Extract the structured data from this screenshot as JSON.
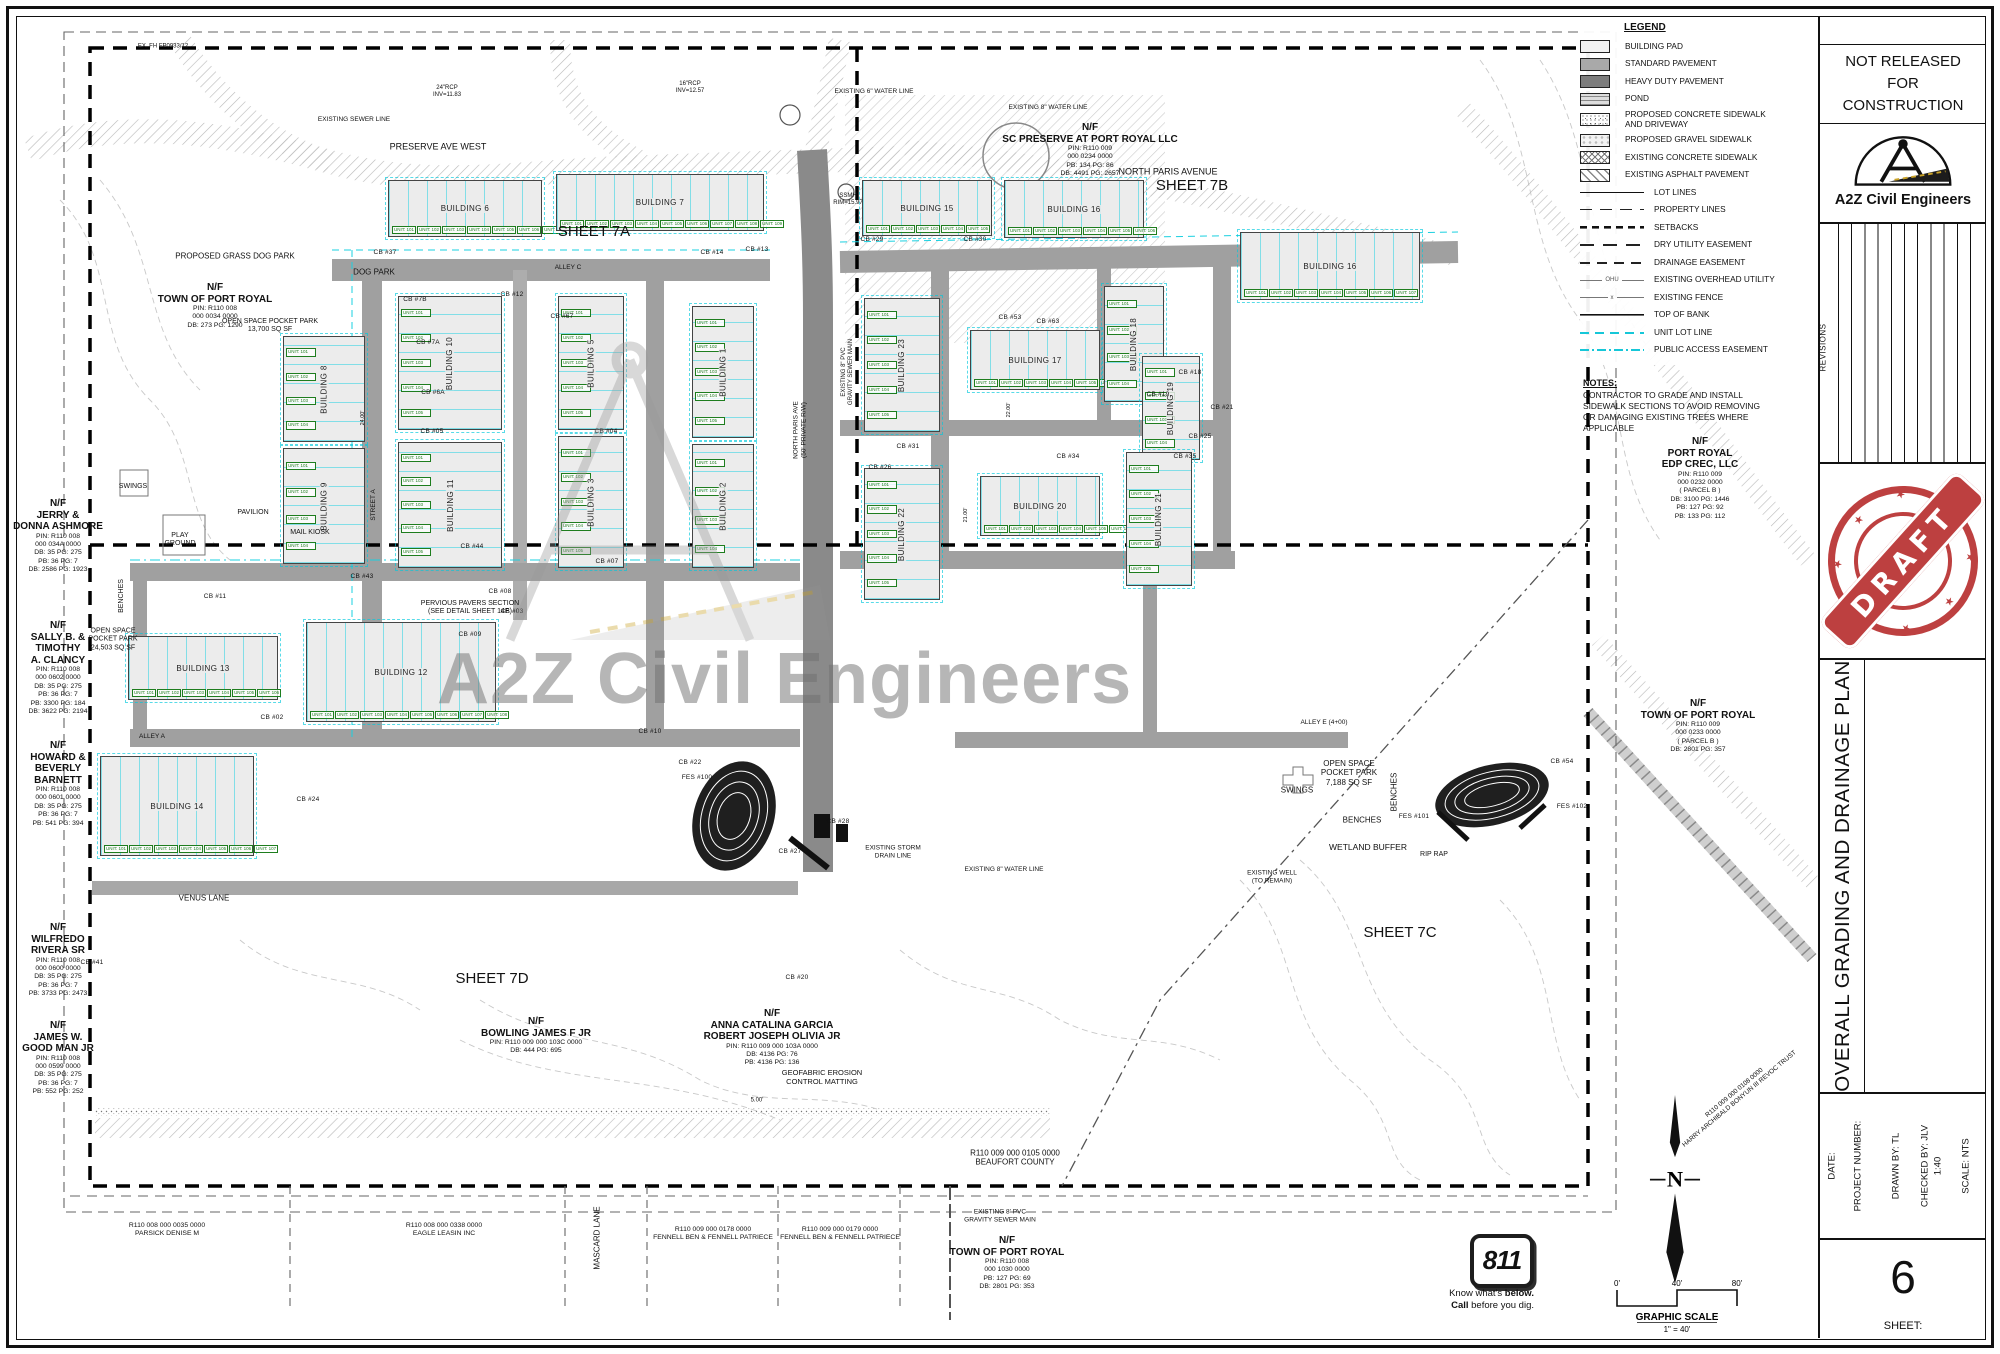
{
  "title_block": {
    "nr1": "NOT RELEASED",
    "nr2": "FOR",
    "nr3": "CONSTRUCTION",
    "firm": "A2Z Civil Engineers",
    "revisions": "REVISIONS",
    "stamp": "DRAFT",
    "sheet_title": "OVERALL GRADING AND DRAINAGE PLAN",
    "date": "DATE:",
    "project": "PROJECT NUMBER:",
    "drawn": "DRAWN BY:  TL",
    "checked": "CHECKED BY:  JLV",
    "ratio": "1:40",
    "scale": "SCALE: NTS",
    "sheet_label": "SHEET:",
    "sheet_number": "6",
    "stamp_color": "#b93232"
  },
  "legend": {
    "title": "LEGEND",
    "fills": [
      {
        "k": "pad",
        "label": "BUILDING PAD"
      },
      {
        "k": "std",
        "label": "STANDARD PAVEMENT"
      },
      {
        "k": "heavy",
        "label": "HEAVY DUTY PAVEMENT"
      },
      {
        "k": "pond",
        "label": "POND"
      },
      {
        "k": "conc",
        "label": "PROPOSED CONCRETE SIDEWALK\nAND DRIVEWAY"
      },
      {
        "k": "gravel",
        "label": "PROPOSED GRAVEL SIDEWALK"
      },
      {
        "k": "xconc",
        "label": "EXISTING CONCRETE SIDEWALK"
      },
      {
        "k": "asph",
        "label": "EXISTING ASPHALT PAVEMENT"
      }
    ],
    "lines": [
      {
        "k": "lot",
        "label": "LOT LINES"
      },
      {
        "k": "prop",
        "label": "PROPERTY LINES"
      },
      {
        "k": "set",
        "label": "SETBACKS"
      },
      {
        "k": "dry",
        "label": "DRY UTILITY EASEMENT"
      },
      {
        "k": "drain",
        "label": "DRAINAGE  EASEMENT"
      },
      {
        "k": "ohu",
        "label": "EXISTING OVERHEAD UTILITY",
        "mid": "OHU"
      },
      {
        "k": "fence",
        "label": "EXISTING FENCE",
        "mid": "x"
      },
      {
        "k": "bank",
        "label": "TOP OF BANK"
      },
      {
        "k": "unitl",
        "label": "UNIT LOT LINE"
      },
      {
        "k": "pub",
        "label": "PUBLIC ACCESS EASEMENT"
      }
    ],
    "unit_line_color": "#16c7d8"
  },
  "notes": {
    "title": "NOTES:",
    "lines": [
      "CONTRACTOR TO GRADE AND INSTALL",
      "SIDEWALK SECTIONS TO AVOID REMOVING",
      "OR DAMAGING EXISTING TREES WHERE",
      "APPLICABLE"
    ]
  },
  "watermark": {
    "text": "A2Z Civil Engineers"
  },
  "north_label": "N",
  "scalebar": {
    "t0": "0'",
    "t40": "40'",
    "t80": "80'",
    "title": "GRAPHIC SCALE",
    "ratio": "1\" = 40'"
  },
  "call811": {
    "number": "811",
    "know": "Know what's ",
    "below": "below.",
    "call": "Call ",
    "dig": "before you dig."
  },
  "plan": {
    "unit_prefix": "UNIT: ",
    "owners": [
      {
        "x": 215,
        "y": 282,
        "b": [
          "N/F",
          "TOWN OF PORT ROYAL"
        ],
        "s": [
          "PIN: R110 008",
          "000 0034 0000",
          "DB: 273      PG: 1290"
        ]
      },
      {
        "x": 58,
        "y": 498,
        "b": [
          "N/F",
          "JERRY &",
          "DONNA ASHMORE"
        ],
        "s": [
          "PIN: R110 008",
          "000 034A 0000",
          "DB: 35      PG: 275",
          "PB: 36      PG: 7",
          "DB: 2586    PG: 1923"
        ]
      },
      {
        "x": 58,
        "y": 620,
        "b": [
          "N/F",
          "SALLY B. &",
          "TIMOTHY",
          "A. CLANCY"
        ],
        "s": [
          "PIN: R110 008",
          "000 0602 0000",
          "DB: 35      PG: 275",
          "PB: 36      PG: 7",
          "PB: 3300    PG: 184",
          "DB: 3622    PG: 2194"
        ]
      },
      {
        "x": 58,
        "y": 740,
        "b": [
          "N/F",
          "HOWARD &",
          "BEVERLY",
          "BARNETT"
        ],
        "s": [
          "PIN: R110 008",
          "000 0601 0000",
          "DB: 35      PG: 275",
          "PB: 36      PG: 7",
          "PB: 541      PG: 394"
        ]
      },
      {
        "x": 58,
        "y": 922,
        "b": [
          "N/F",
          "WILFREDO",
          "RIVERA SR"
        ],
        "s": [
          "PIN: R110 008",
          "000 0600 0000",
          "DB: 35      PG: 275",
          "PB: 36      PG: 7",
          "PB: 3733    PG: 2473"
        ]
      },
      {
        "x": 58,
        "y": 1020,
        "b": [
          "N/F",
          "JAMES W.",
          "GOOD MAN JR"
        ],
        "s": [
          "PIN: R110 008",
          "000 0599 0000",
          "DB: 35      PG: 275",
          "PB: 36      PG: 7",
          "PB: 552      PG: 252"
        ]
      },
      {
        "x": 1090,
        "y": 122,
        "b": [
          "N/F",
          "SC PRESERVE AT PORT ROYAL LLC"
        ],
        "s": [
          "PIN: R110 009",
          "000 0234 0000",
          "PB: 134      PG: 86",
          "DB: 4491    PG: 2657"
        ]
      },
      {
        "x": 1700,
        "y": 436,
        "b": [
          "N/F",
          "PORT ROYAL",
          "EDP CREC, LLC"
        ],
        "s": [
          "PIN: R110 009",
          "000 0232 0000",
          "( PARCEL B )",
          "DB: 3100    PG: 1446",
          "PB: 127      PG: 92",
          "PB: 133      PG: 112"
        ]
      },
      {
        "x": 1698,
        "y": 698,
        "b": [
          "N/F",
          "TOWN OF PORT ROYAL"
        ],
        "s": [
          "PIN: R110 009",
          "000 0233 0000",
          "( PARCEL B )",
          "DB: 2801    PG: 357"
        ]
      },
      {
        "x": 536,
        "y": 1016,
        "b": [
          "N/F",
          "BOWLING JAMES F JR"
        ],
        "s": [
          "PIN: R110 009 000 103C 0000",
          "DB: 444      PG: 695"
        ]
      },
      {
        "x": 772,
        "y": 1008,
        "b": [
          "N/F",
          "ANNA CATALINA GARCIA",
          "ROBERT JOSEPH OLIVIA JR"
        ],
        "s": [
          "PIN: R110 009 000 103A 0000",
          "DB: 4136      PG: 76",
          "PB: 4136      PG: 136"
        ]
      },
      {
        "x": 1007,
        "y": 1235,
        "b": [
          "N/F",
          "TOWN OF PORT ROYAL"
        ],
        "s": [
          "PIN: R110 008",
          "000 1030 0000",
          "PB: 127      PG: 69",
          "DB: 2801    PG: 353"
        ]
      },
      {
        "x": 167,
        "y": 1222,
        "b": [],
        "s": [
          "R110 008 000 0035 0000",
          "PARSICK DENISE M"
        ]
      },
      {
        "x": 444,
        "y": 1222,
        "b": [],
        "s": [
          "R110 008 000 0338 0000",
          "EAGLE LEASIN INC"
        ]
      },
      {
        "x": 713,
        "y": 1226,
        "b": [],
        "s": [
          "R110 009 000 0178 0000",
          "FENNELL BEN & FENNELL PATRIECE"
        ]
      },
      {
        "x": 840,
        "y": 1226,
        "b": [],
        "s": [
          "R110 009 000 0179 0000",
          "FENNELL BEN & FENNELL PATRIECE"
        ]
      }
    ],
    "labels": [
      {
        "t": "PRESERVE AVE WEST",
        "x": 438,
        "y": 147,
        "s": 9
      },
      {
        "t": "NORTH PARIS AVENUE",
        "x": 1168,
        "y": 172,
        "s": 9
      },
      {
        "t": "SHEET 7A",
        "x": 594,
        "y": 232,
        "s": 15
      },
      {
        "t": "SHEET 7B",
        "x": 1192,
        "y": 186,
        "s": 15
      },
      {
        "t": "SHEET 7C",
        "x": 1400,
        "y": 933,
        "s": 15
      },
      {
        "t": "SHEET 7D",
        "x": 492,
        "y": 979,
        "s": 15
      },
      {
        "t": "VENUS LANE",
        "x": 204,
        "y": 898,
        "s": 8
      },
      {
        "t": "MASCARD LANE",
        "x": 597,
        "y": 1238,
        "r": -90,
        "s": 8
      },
      {
        "t": "DOG PARK",
        "x": 374,
        "y": 272,
        "s": 8
      },
      {
        "t": "PROPOSED GRASS DOG PARK",
        "x": 235,
        "y": 256,
        "s": 8
      },
      {
        "t": "OPEN SPACE POCKET PARK\n13,700 SQ SF",
        "x": 270,
        "y": 326,
        "s": 7
      },
      {
        "t": "OPEN SPACE\nPOCKET PARK\n24,503 SQ SF",
        "x": 113,
        "y": 640,
        "s": 7
      },
      {
        "t": "SWINGS",
        "x": 133,
        "y": 487,
        "s": 7
      },
      {
        "t": "PLAY\nGROUND",
        "x": 180,
        "y": 540,
        "s": 7
      },
      {
        "t": "PAVILION",
        "x": 253,
        "y": 513,
        "s": 7
      },
      {
        "t": "MAIL KIOSK",
        "x": 310,
        "y": 533,
        "s": 7
      },
      {
        "t": "BENCHES",
        "x": 122,
        "y": 596,
        "r": -90,
        "s": 7
      },
      {
        "t": "BENCHES",
        "x": 1394,
        "y": 792,
        "r": -90,
        "s": 8
      },
      {
        "t": "BENCHES",
        "x": 1362,
        "y": 820,
        "s": 8
      },
      {
        "t": "OPEN SPACE\nPOCKET PARK\n7,188 SQ SF",
        "x": 1349,
        "y": 773,
        "s": 8
      },
      {
        "t": "SWINGS",
        "x": 1297,
        "y": 790,
        "s": 8
      },
      {
        "t": "WETLAND BUFFER",
        "x": 1368,
        "y": 847,
        "s": 8.5
      },
      {
        "t": "RIP RAP",
        "x": 1434,
        "y": 855,
        "s": 7
      },
      {
        "t": "EXISTING WELL\n(TO REMAIN)",
        "x": 1272,
        "y": 877,
        "s": 6.5
      },
      {
        "t": "ALLEY E (4+00)",
        "x": 1324,
        "y": 723,
        "s": 6.5
      },
      {
        "t": "ALLEY C",
        "x": 568,
        "y": 268,
        "s": 6.5
      },
      {
        "t": "ALLEY A",
        "x": 152,
        "y": 737,
        "s": 6.5
      },
      {
        "t": "STREET A",
        "x": 374,
        "y": 505,
        "r": -90,
        "s": 6.5
      },
      {
        "t": "NORTH PARIS AVE\n(50' PRIVATE R/W)",
        "x": 800,
        "y": 430,
        "r": -90,
        "s": 6.5
      },
      {
        "t": "EXISTING 8\" PVC\nGRAVITY SEWER MAIN",
        "x": 848,
        "y": 372,
        "r": -90,
        "s": 6
      },
      {
        "t": "PERVIOUS PAVERS SECTION\n(SEE DETAIL SHEET 14E)",
        "x": 470,
        "y": 608,
        "s": 7
      },
      {
        "t": "GEOFABRIC EROSION\nCONTROL MATTING",
        "x": 822,
        "y": 1078,
        "s": 7.5
      },
      {
        "t": "EXISTING 8\" WATER LINE",
        "x": 1048,
        "y": 108,
        "s": 6.5
      },
      {
        "t": "EXISTING SEWER LINE",
        "x": 354,
        "y": 120,
        "s": 6.5
      },
      {
        "t": "EX. FH FP0933/12",
        "x": 163,
        "y": 47,
        "s": 6
      },
      {
        "t": "24\"RCP\nINV=11.83",
        "x": 447,
        "y": 92,
        "s": 6
      },
      {
        "t": "16\"RCP\nINV=12.57",
        "x": 690,
        "y": 88,
        "s": 6
      },
      {
        "t": "EXISTING 6\" WATER LINE",
        "x": 874,
        "y": 92,
        "s": 6.5
      },
      {
        "t": "EXISTING 8\" WATER LINE",
        "x": 1004,
        "y": 870,
        "s": 6.5
      },
      {
        "t": "EXISTING STORM\nDRAIN LINE",
        "x": 893,
        "y": 852,
        "s": 6.5
      },
      {
        "t": "EXISTING 8' PVC\nGRAVITY SEWER MAIN",
        "x": 1000,
        "y": 1216,
        "s": 6.5
      },
      {
        "t": "SSMH\nRIM=15.97",
        "x": 848,
        "y": 200,
        "s": 6
      },
      {
        "t": "R110 009 000 0105 0000\nBEAUFORT COUNTY",
        "x": 1015,
        "y": 1158,
        "s": 8
      },
      {
        "t": "R110 009 000 0108 0000\nHARRY ARCHIBALD BONYUN III REVOC TRUST",
        "x": 1737,
        "y": 1096,
        "r": -40,
        "s": 6.5
      },
      {
        "t": "5.00'",
        "x": 757,
        "y": 1101,
        "s": 6
      },
      {
        "t": "24.00'",
        "x": 363,
        "y": 418,
        "r": -90,
        "s": 5.5
      },
      {
        "t": "22.00'",
        "x": 1009,
        "y": 410,
        "r": -90,
        "s": 5.5
      },
      {
        "t": "21.00'",
        "x": 966,
        "y": 515,
        "r": -90,
        "s": 5.5
      },
      {
        "t": "CB #37",
        "x": 385,
        "y": 253,
        "c": "cb"
      },
      {
        "t": "CB #13",
        "x": 757,
        "y": 250,
        "c": "cb"
      },
      {
        "t": "CB #14",
        "x": 712,
        "y": 253,
        "c": "cb"
      },
      {
        "t": "CB #29",
        "x": 872,
        "y": 240,
        "c": "cb"
      },
      {
        "t": "CB #30",
        "x": 975,
        "y": 240,
        "c": "cb"
      },
      {
        "t": "CB #7B",
        "x": 415,
        "y": 300,
        "c": "cb"
      },
      {
        "t": "CB #7A",
        "x": 428,
        "y": 343,
        "c": "cb"
      },
      {
        "t": "CB #6A",
        "x": 433,
        "y": 393,
        "c": "cb"
      },
      {
        "t": "CB #12",
        "x": 512,
        "y": 295,
        "c": "cb"
      },
      {
        "t": "CB #67",
        "x": 562,
        "y": 317,
        "c": "cb"
      },
      {
        "t": "CB #05",
        "x": 432,
        "y": 432,
        "c": "cb"
      },
      {
        "t": "CB #04",
        "x": 606,
        "y": 432,
        "c": "cb"
      },
      {
        "t": "CB #63",
        "x": 1048,
        "y": 322,
        "c": "cb"
      },
      {
        "t": "CB #53",
        "x": 1010,
        "y": 318,
        "c": "cb"
      },
      {
        "t": "CB #31",
        "x": 908,
        "y": 447,
        "c": "cb"
      },
      {
        "t": "CB #26",
        "x": 880,
        "y": 468,
        "c": "cb"
      },
      {
        "t": "CB #34",
        "x": 1068,
        "y": 457,
        "c": "cb"
      },
      {
        "t": "CB #35",
        "x": 1185,
        "y": 457,
        "c": "cb"
      },
      {
        "t": "CB #25",
        "x": 1200,
        "y": 437,
        "c": "cb"
      },
      {
        "t": "CB #21",
        "x": 1222,
        "y": 408,
        "c": "cb"
      },
      {
        "t": "CB #19",
        "x": 1158,
        "y": 395,
        "c": "cb"
      },
      {
        "t": "CB #18",
        "x": 1190,
        "y": 373,
        "c": "cb"
      },
      {
        "t": "CB #44",
        "x": 472,
        "y": 547,
        "c": "cb"
      },
      {
        "t": "CB #07",
        "x": 607,
        "y": 562,
        "c": "cb"
      },
      {
        "t": "CB #43",
        "x": 362,
        "y": 577,
        "c": "cb"
      },
      {
        "t": "CB #11",
        "x": 215,
        "y": 597,
        "c": "cb"
      },
      {
        "t": "CB #08",
        "x": 500,
        "y": 592,
        "c": "cb"
      },
      {
        "t": "CB #09",
        "x": 470,
        "y": 635,
        "c": "cb"
      },
      {
        "t": "CB #03",
        "x": 512,
        "y": 612,
        "c": "cb"
      },
      {
        "t": "CB #02",
        "x": 272,
        "y": 718,
        "c": "cb"
      },
      {
        "t": "CB #10",
        "x": 650,
        "y": 732,
        "c": "cb"
      },
      {
        "t": "CB #24",
        "x": 308,
        "y": 800,
        "c": "cb"
      },
      {
        "t": "CB #41",
        "x": 92,
        "y": 963,
        "c": "cb"
      },
      {
        "t": "CB #20",
        "x": 797,
        "y": 978,
        "c": "cb"
      },
      {
        "t": "CB #22",
        "x": 690,
        "y": 763,
        "c": "cb"
      },
      {
        "t": "FES #100",
        "x": 697,
        "y": 778,
        "c": "cb"
      },
      {
        "t": "CB #27",
        "x": 790,
        "y": 852,
        "c": "cb"
      },
      {
        "t": "CB #28",
        "x": 838,
        "y": 822,
        "c": "cb"
      },
      {
        "t": "CB #54",
        "x": 1562,
        "y": 762,
        "c": "cb"
      },
      {
        "t": "FES #101",
        "x": 1414,
        "y": 817,
        "c": "cb"
      },
      {
        "t": "FES #102",
        "x": 1572,
        "y": 807,
        "c": "cb"
      }
    ],
    "buildings": [
      {
        "l": "BUILDING 6",
        "x": 388,
        "y": 180,
        "w": 152,
        "h": 55,
        "v": false,
        "u": 7
      },
      {
        "l": "BUILDING 7",
        "x": 556,
        "y": 174,
        "w": 206,
        "h": 55,
        "v": false,
        "u": 9
      },
      {
        "l": "BUILDING 15",
        "x": 862,
        "y": 180,
        "w": 128,
        "h": 54,
        "v": false,
        "u": 5
      },
      {
        "l": "BUILDING 16",
        "x": 1004,
        "y": 180,
        "w": 138,
        "h": 56,
        "v": false,
        "u": 6
      },
      {
        "l": "BUILDING 16",
        "x": 1240,
        "y": 232,
        "w": 178,
        "h": 66,
        "v": false,
        "u": 7
      },
      {
        "l": "BUILDING 8",
        "x": 283,
        "y": 336,
        "w": 80,
        "h": 104,
        "v": true,
        "u": 4
      },
      {
        "l": "BUILDING 9",
        "x": 283,
        "y": 448,
        "w": 80,
        "h": 114,
        "v": true,
        "u": 4
      },
      {
        "l": "BUILDING 10",
        "x": 398,
        "y": 296,
        "w": 102,
        "h": 132,
        "v": true,
        "u": 5
      },
      {
        "l": "BUILDING 11",
        "x": 398,
        "y": 442,
        "w": 102,
        "h": 124,
        "v": true,
        "u": 5
      },
      {
        "l": "BUILDING 5",
        "x": 558,
        "y": 296,
        "w": 64,
        "h": 132,
        "v": true,
        "u": 5
      },
      {
        "l": "BUILDING 3",
        "x": 558,
        "y": 436,
        "w": 64,
        "h": 130,
        "v": true,
        "u": 5
      },
      {
        "l": "BUILDING 1",
        "x": 692,
        "y": 306,
        "w": 60,
        "h": 130,
        "v": true,
        "u": 5
      },
      {
        "l": "BUILDING 2",
        "x": 692,
        "y": 444,
        "w": 60,
        "h": 122,
        "v": true,
        "u": 4
      },
      {
        "l": "BUILDING 23",
        "x": 864,
        "y": 298,
        "w": 74,
        "h": 132,
        "v": true,
        "u": 5
      },
      {
        "l": "BUILDING 17",
        "x": 970,
        "y": 330,
        "w": 128,
        "h": 58,
        "v": false,
        "u": 6
      },
      {
        "l": "BUILDING 18",
        "x": 1104,
        "y": 286,
        "w": 58,
        "h": 114,
        "v": true,
        "u": 4
      },
      {
        "l": "BUILDING 19",
        "x": 1142,
        "y": 356,
        "w": 56,
        "h": 102,
        "v": true,
        "u": 4
      },
      {
        "l": "BUILDING 20",
        "x": 980,
        "y": 476,
        "w": 118,
        "h": 58,
        "v": false,
        "u": 6
      },
      {
        "l": "BUILDING 22",
        "x": 864,
        "y": 468,
        "w": 74,
        "h": 130,
        "v": true,
        "u": 5
      },
      {
        "l": "BUILDING 21",
        "x": 1126,
        "y": 452,
        "w": 64,
        "h": 132,
        "v": true,
        "u": 5
      },
      {
        "l": "BUILDING 13",
        "x": 128,
        "y": 636,
        "w": 148,
        "h": 62,
        "v": false,
        "u": 6
      },
      {
        "l": "BUILDING 12",
        "x": 306,
        "y": 622,
        "w": 188,
        "h": 98,
        "v": false,
        "u": 8
      },
      {
        "l": "BUILDING 14",
        "x": 100,
        "y": 756,
        "w": 152,
        "h": 98,
        "v": false,
        "u": 7
      }
    ]
  }
}
